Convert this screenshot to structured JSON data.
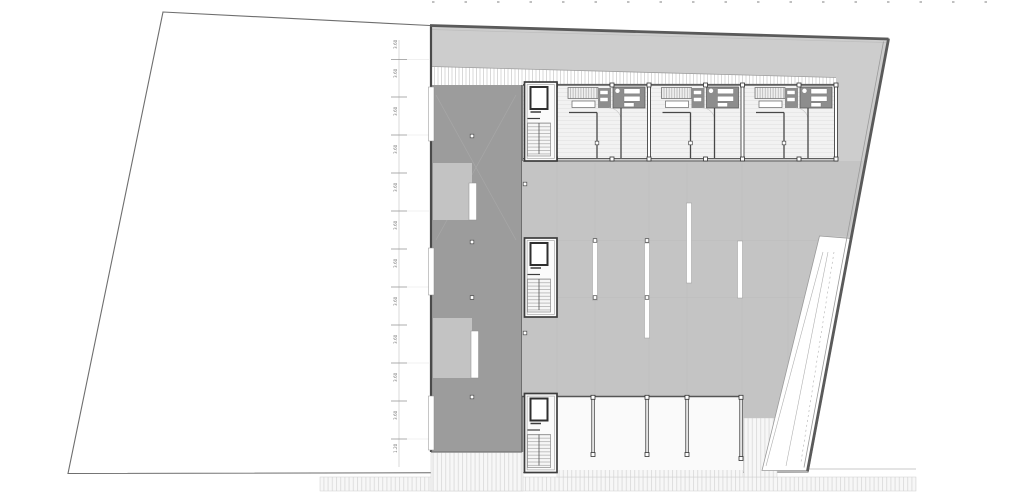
{
  "drawing": {
    "kind": "architectural-floor-plan",
    "units_count": 3,
    "stair_cores_count": 3
  },
  "colors": {
    "paper": "#ffffff",
    "site_fill": "#ffffff",
    "outline": "#6e6e6e",
    "edge_heavy": "#5a5a5a",
    "roof": "#cdcdcd",
    "hall": "#c4c4c4",
    "spine": "#9c9c9c",
    "spine_patch": "#c3c3c3",
    "unit_floor": "#f2f2f2",
    "furniture": "#8d8d8d",
    "wall": "#474747",
    "hatch_line": "#d8d8d8",
    "pavement_line": "#dedede",
    "grid_line": "#b8b8b8",
    "slot_white": "#ffffff",
    "ramp_line": "#9a9a9a",
    "dim_line": "#c9c9c9",
    "dim_tick": "#9a9a9a",
    "dim_text": "#777777"
  },
  "dimension_column": {
    "labels": [
      "3.60",
      "3.60",
      "3.60",
      "3.60",
      "3.60",
      "3.60",
      "3.60",
      "3.60",
      "3.60",
      "3.60",
      "3.60",
      "1.20"
    ]
  }
}
